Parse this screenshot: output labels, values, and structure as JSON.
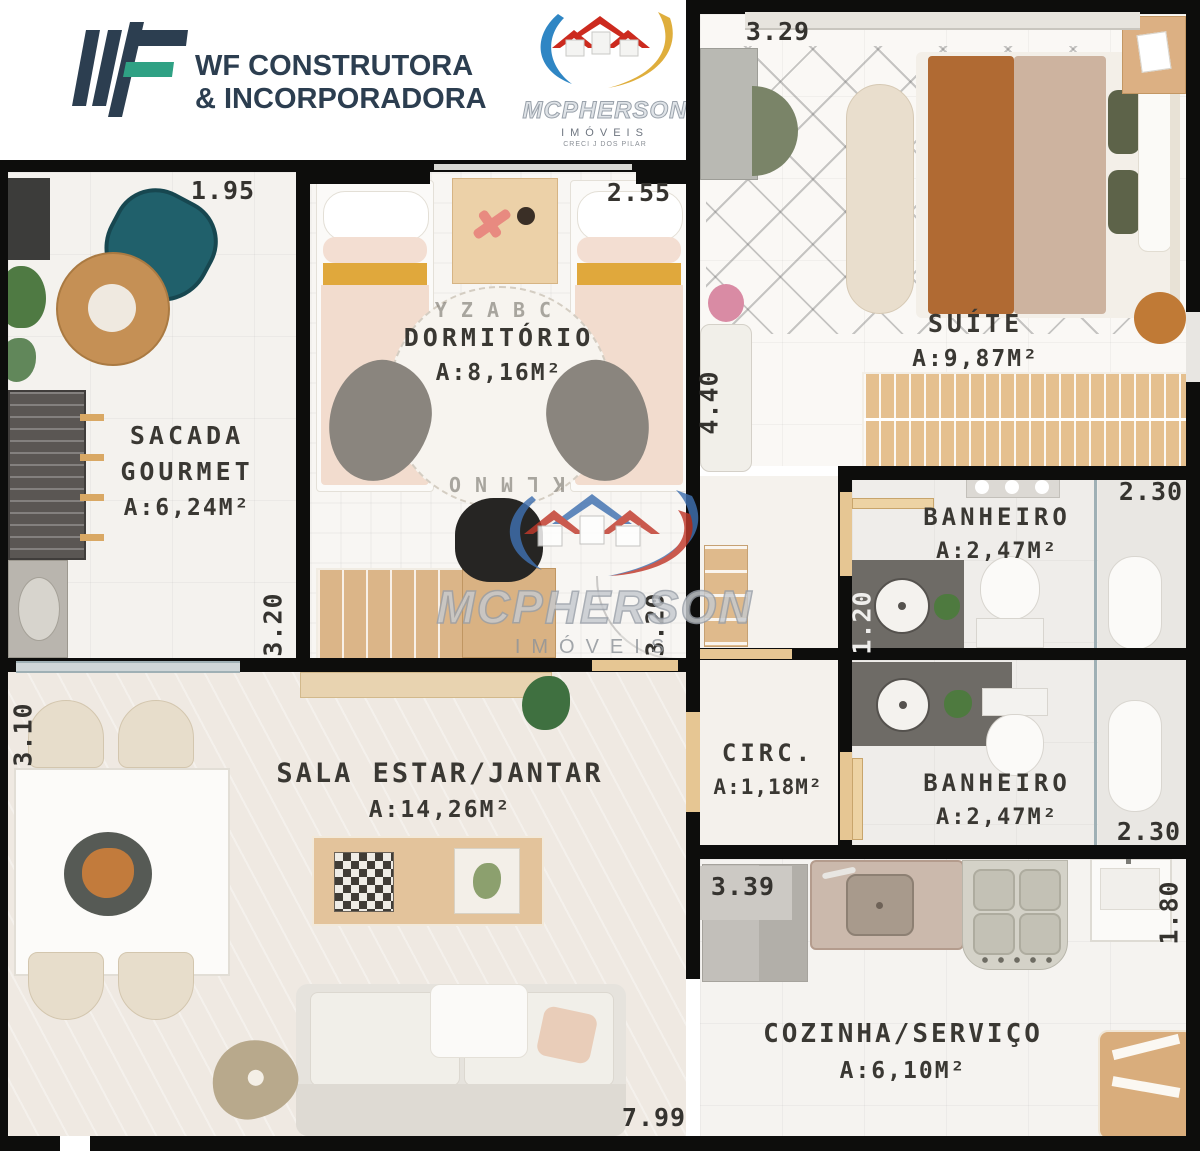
{
  "header": {
    "line1_prefix": "WF",
    "line1_rest": "CONSTRUTORA",
    "line2": "& INCORPORADORA",
    "mcpherson": {
      "name": "MCPHERSON",
      "subtitle": "IMÓVEIS",
      "caption": "CRECI J DOS PILAR"
    }
  },
  "watermark": {
    "name": "MCPHERSON",
    "subtitle": "IMÓVEIS"
  },
  "rooms": {
    "sacada": {
      "line1": "SACADA",
      "line2": "GOURMET",
      "area": "A:6,24M²"
    },
    "dormitorio": {
      "name": "DORMITÓRIO",
      "area": "A:8,16M²"
    },
    "suite": {
      "name": "SUÍTE",
      "area": "A:9,87M²"
    },
    "banheiro_suite": {
      "name": "BANHEIRO",
      "area": "A:2,47M²"
    },
    "circulacao": {
      "name": "CIRC.",
      "area": "A:1,18M²"
    },
    "banheiro_social": {
      "name": "BANHEIRO",
      "area": "A:2,47M²"
    },
    "sala": {
      "name": "SALA ESTAR/JANTAR",
      "area": "A:14,26M²"
    },
    "cozinha": {
      "name": "COZINHA/SERVIÇO",
      "area": "A:6,10M²"
    }
  },
  "dormitorio_rug": {
    "top": "YZABC",
    "bottom": "KLMNO"
  },
  "dimensions": {
    "sacada_width": "1.95",
    "dormitorio_width": "2.55",
    "suite_width": "3.29",
    "dormitorio_height": "4.40",
    "banheiro_suite_width": "2.30",
    "banheiro_suite_height": "1.20",
    "banheiro_social_width": "2.30",
    "servico_height": "1.80",
    "cozinha_width": "3.39",
    "sala_height": "3.10",
    "sacada_height": "3.20",
    "dormitorio_inner_height": "3.20",
    "total_width": "7.99"
  },
  "colors": {
    "wall": "#0d0d0c",
    "wf_navy": "#2c3e50",
    "wf_teal": "#2fa184",
    "mcpherson_blue": "#2f86c4",
    "mcpherson_red": "#c0392b",
    "mcpherson_yellow": "#dfae3c",
    "wood": "#e3c18f",
    "label_text": "#3a3833"
  }
}
